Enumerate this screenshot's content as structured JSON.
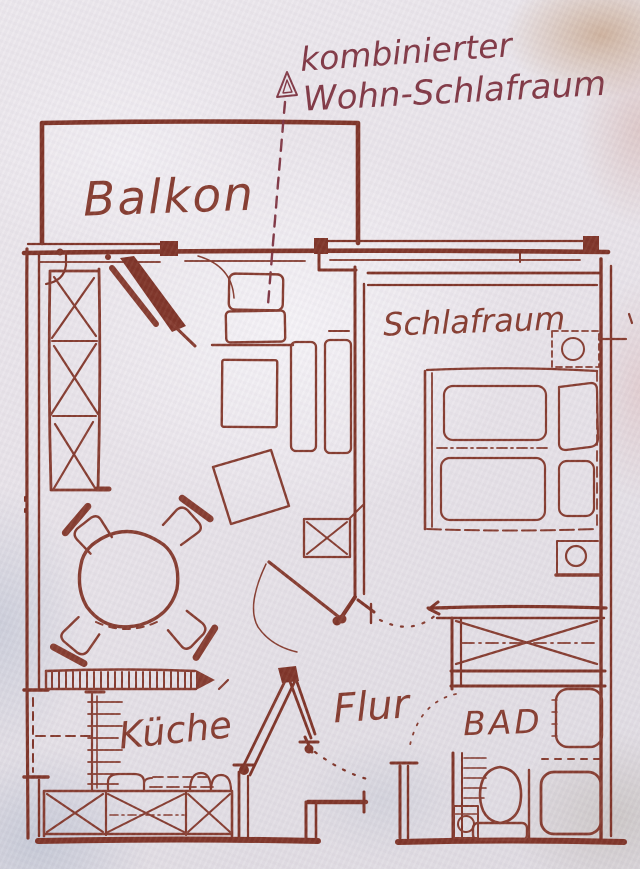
{
  "meta": {
    "kind": "scanned hand-drawn apartment floor plan sketch"
  },
  "colors": {
    "ink": "#83372a",
    "ink_dark": "#772d20",
    "annotation_ink": "#7e3340",
    "paper": "#e8e4e9"
  },
  "annotation": {
    "line1": "kombinierter",
    "line2": "Wohn-Schlafraum"
  },
  "rooms": {
    "balcony": {
      "label": "Balkon"
    },
    "bedroom": {
      "label": "Schlafraum"
    },
    "hallway": {
      "label": "Flur"
    },
    "kitchen": {
      "label": "Küche"
    },
    "bathroom": {
      "label": "BAD"
    }
  },
  "symbols": [
    "dashed-direction-arrow",
    "balcony-door-swing",
    "wardrobe-with-x-panels",
    "sideboard",
    "small-table",
    "shelf-rectangles",
    "rotated-square-table",
    "cabinet-with-x",
    "room-door-leaf-with-swing",
    "round-dining-table",
    "four-chairs",
    "double-bed",
    "two-mattresses",
    "two-pillows",
    "nightstand-with-lamp",
    "closet-with-x",
    "washbasin",
    "shower-tray",
    "toilet-with-cistern",
    "hatched-radiator-band",
    "shelf-ladder",
    "kitchen-counter-with-x",
    "sink-basins",
    "stove",
    "open-entrance-door",
    "dashed-door-swing-arcs",
    "window-dashed-opening"
  ]
}
